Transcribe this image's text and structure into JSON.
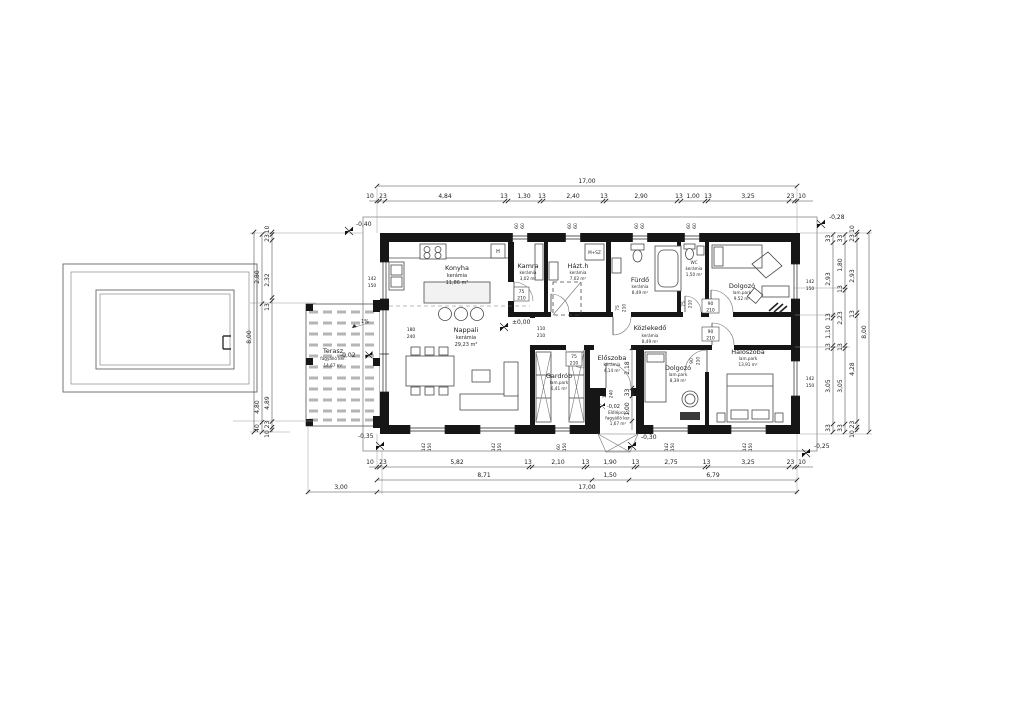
{
  "rooms": {
    "konyha": {
      "name": "Konyha",
      "floor": "kerámia",
      "area": "11,86 m²"
    },
    "nappali": {
      "name": "Nappali",
      "floor": "kerámia",
      "area": "29,23 m²"
    },
    "kamra": {
      "name": "Kamra",
      "floor": "kerámia",
      "area": "3,02 m²"
    },
    "hazth": {
      "name": "Házt.h",
      "floor": "kerámia",
      "area": "7,02 m²"
    },
    "furdo": {
      "name": "Fürdő",
      "floor": "kerámia",
      "area": "8,49 m²"
    },
    "wc": {
      "name": "WC",
      "floor": "kerámia",
      "area": "1,50 m²"
    },
    "dolgozo1": {
      "name": "Dolgozó",
      "floor": "lam.park",
      "area": "9,52 m²"
    },
    "kozlekedo": {
      "name": "Közlekedő",
      "floor": "kerámia",
      "area": "8,49 m²"
    },
    "eloszoba": {
      "name": "Előszoba",
      "floor": "kerámia",
      "area": "4,14 m²"
    },
    "gardrob": {
      "name": "Gardrób",
      "floor": "lam.park",
      "area": "6,41 m²"
    },
    "dolgozo2": {
      "name": "Dolgozó",
      "floor": "lam.park",
      "area": "8,39 m²"
    },
    "haloszoba": {
      "name": "Hálószoba",
      "floor": "lam.park",
      "area": "13,91 m²"
    },
    "terasz": {
      "name": "Terasz",
      "floor": "fagyálló ker.",
      "area": "14,67 m²"
    },
    "elolepcso": {
      "name": "Előlépcső",
      "floor": "fagyálló ker.",
      "area": "1,67 m²"
    }
  },
  "levels": {
    "interior": "±0,00",
    "terrace": "-0,02",
    "porch": "-0,02",
    "top_left": "-0,40",
    "top_right": "-0,28",
    "bottom_right": "-0,25",
    "bottom_left": "-0,35",
    "entrance": "-0,30"
  },
  "openings": {
    "w6060": {
      "a": "60",
      "b": "60"
    },
    "w142": {
      "a": "142",
      "b": "150"
    },
    "w60150": {
      "a": "60",
      "b": "150"
    },
    "d180": {
      "a": "180",
      "b": "240"
    },
    "d110": {
      "a": "110",
      "b": "210"
    },
    "d90": {
      "a": "90",
      "b": "210"
    },
    "d75": {
      "a": "75",
      "b": "210"
    },
    "d100": {
      "a": "100",
      "b": "240"
    }
  },
  "annotations": {
    "slope": "1%",
    "washer": "M+SZ",
    "fridge": "H"
  },
  "dim_chains": [
    {
      "name": "top-total",
      "dir": "h",
      "y": 186,
      "x1": 377,
      "x2": 797,
      "ticks": [
        377,
        797
      ],
      "ty": 183,
      "labels": [
        {
          "v": "17,00",
          "x": 587
        }
      ]
    },
    {
      "name": "top-chain",
      "dir": "h",
      "y": 201,
      "x1": 369,
      "x2": 813,
      "ticks": [
        377,
        379.5,
        385,
        505,
        508,
        540,
        543,
        603,
        606,
        677,
        681,
        705,
        708,
        789,
        794.5,
        797
      ],
      "ty": 198,
      "labels": [
        {
          "v": "10",
          "x": 370
        },
        {
          "v": "23",
          "x": 383
        },
        {
          "v": "4,84",
          "x": 445
        },
        {
          "v": "13",
          "x": 504
        },
        {
          "v": "1,30",
          "x": 524
        },
        {
          "v": "13",
          "x": 542
        },
        {
          "v": "2,40",
          "x": 573
        },
        {
          "v": "13",
          "x": 604
        },
        {
          "v": "2,90",
          "x": 641
        },
        {
          "v": "13",
          "x": 679
        },
        {
          "v": "1,00",
          "x": 693
        },
        {
          "v": "13",
          "x": 708
        },
        {
          "v": "3,25",
          "x": 748
        },
        {
          "v": "23",
          "x": 790.5
        },
        {
          "v": "10",
          "x": 802
        }
      ]
    },
    {
      "name": "bottom-chain",
      "dir": "h",
      "y": 467,
      "x1": 369,
      "x2": 813,
      "ticks": [
        377,
        379.5,
        385,
        529,
        532,
        584,
        587,
        634,
        637,
        705,
        708,
        789,
        794.5,
        797
      ],
      "ty": 464,
      "labels": [
        {
          "v": "10",
          "x": 370
        },
        {
          "v": "23",
          "x": 383
        },
        {
          "v": "5,82",
          "x": 457
        },
        {
          "v": "13",
          "x": 528
        },
        {
          "v": "2,10",
          "x": 558
        },
        {
          "v": "13",
          "x": 585.5
        },
        {
          "v": "1,90",
          "x": 610
        },
        {
          "v": "13",
          "x": 635.5
        },
        {
          "v": "2,75",
          "x": 671
        },
        {
          "v": "13",
          "x": 706.5
        },
        {
          "v": "3,25",
          "x": 748
        },
        {
          "v": "23",
          "x": 790.5
        },
        {
          "v": "10",
          "x": 802
        }
      ]
    },
    {
      "name": "bottom-row2",
      "dir": "h",
      "y": 480,
      "x1": 377,
      "x2": 797,
      "ticks": [
        377,
        592,
        629,
        797
      ],
      "ty": 477,
      "labels": [
        {
          "v": "8,71",
          "x": 484
        },
        {
          "v": "1,50",
          "x": 610
        },
        {
          "v": "6,79",
          "x": 713
        }
      ]
    },
    {
      "name": "bottom-total",
      "dir": "h",
      "y": 492,
      "x1": 377,
      "x2": 797,
      "ticks": [
        377,
        797
      ],
      "ty": 489,
      "labels": [
        {
          "v": "17,00",
          "x": 587
        }
      ]
    },
    {
      "name": "bottom-gap",
      "dir": "h",
      "y": 492,
      "x1": 308,
      "x2": 377,
      "ticks": [
        308
      ],
      "ty": 489,
      "labels": [
        {
          "v": "3,00",
          "x": 341
        }
      ]
    },
    {
      "name": "right-1",
      "dir": "v",
      "x": 833,
      "y1": 234,
      "y2": 432,
      "ticks": [
        234.5,
        242.6,
        315,
        318.2,
        345.4,
        348.6,
        424,
        432
      ],
      "tx": 830,
      "labels": [
        {
          "v": "33",
          "y": 238.5
        },
        {
          "v": "2,93",
          "y": 279
        },
        {
          "v": "13",
          "y": 317
        },
        {
          "v": "1,10",
          "y": 332
        },
        {
          "v": "13",
          "y": 347
        },
        {
          "v": "3,05",
          "y": 386
        },
        {
          "v": "33",
          "y": 428
        }
      ]
    },
    {
      "name": "right-2",
      "dir": "v",
      "x": 845,
      "y1": 234,
      "y2": 432,
      "ticks": [
        234.5,
        242.6,
        287,
        290.3,
        345.4,
        348.6,
        424,
        432
      ],
      "tx": 842,
      "labels": [
        {
          "v": "33",
          "y": 238.5
        },
        {
          "v": "1,80",
          "y": 265
        },
        {
          "v": "13",
          "y": 289
        },
        {
          "v": "2,23",
          "y": 318
        },
        {
          "v": "13",
          "y": 347
        },
        {
          "v": "3,05",
          "y": 386
        },
        {
          "v": "33",
          "y": 428
        }
      ]
    },
    {
      "name": "right-3",
      "dir": "v",
      "x": 857,
      "y1": 232,
      "y2": 432,
      "ticks": [
        232,
        234.5,
        240.2,
        312.6,
        315.8,
        421.5,
        427.2,
        430
      ],
      "tx": 854,
      "labels": [
        {
          "v": "10",
          "y": 229
        },
        {
          "v": "23",
          "y": 238
        },
        {
          "v": "2,93",
          "y": 276
        },
        {
          "v": "13",
          "y": 314
        },
        {
          "v": "4,28",
          "y": 369
        },
        {
          "v": "23",
          "y": 424.5
        },
        {
          "v": "10",
          "y": 434
        }
      ]
    },
    {
      "name": "right-total",
      "dir": "v",
      "x": 869,
      "y1": 232,
      "y2": 432,
      "ticks": [
        232,
        432
      ],
      "tx": 866,
      "labels": [
        {
          "v": "8,00",
          "y": 332
        }
      ]
    },
    {
      "name": "pool-a",
      "dir": "v",
      "x": 262,
      "y1": 234,
      "y2": 432,
      "ticks": [
        234.5,
        303.7,
        422.3,
        432
      ],
      "tx": 259,
      "labels": [
        {
          "v": "2,80",
          "y": 277
        },
        {
          "v": "4,80",
          "y": 407
        },
        {
          "v": "40",
          "y": 428
        }
      ]
    },
    {
      "name": "pool-b",
      "dir": "v",
      "x": 272,
      "y1": 232,
      "y2": 432,
      "ticks": [
        232,
        234.5,
        240.2,
        297.5,
        300.7,
        421.5,
        427.2,
        430
      ],
      "tx": 269,
      "labels": [
        {
          "v": "10",
          "y": 229.5
        },
        {
          "v": "23",
          "y": 238
        },
        {
          "v": "2,32",
          "y": 280
        },
        {
          "v": "13",
          "y": 307
        },
        {
          "v": "4,89",
          "y": 403
        },
        {
          "v": "23",
          "y": 424.5
        },
        {
          "v": "10",
          "y": 434
        }
      ]
    },
    {
      "name": "pool-total",
      "dir": "v",
      "x": 254,
      "y1": 232,
      "y2": 432,
      "ticks": [
        232,
        432
      ],
      "tx": 251,
      "labels": [
        {
          "v": "8,00",
          "y": 337
        }
      ]
    },
    {
      "name": "entry-depth",
      "dir": "v",
      "x": 632,
      "y1": 348,
      "y2": 430,
      "ticks": [
        348,
        388,
        396,
        421
      ],
      "tx": 629,
      "labels": [
        {
          "v": "2,18",
          "y": 368
        },
        {
          "v": "33",
          "y": 392.5
        },
        {
          "v": "1,00",
          "y": 409
        }
      ]
    }
  ]
}
